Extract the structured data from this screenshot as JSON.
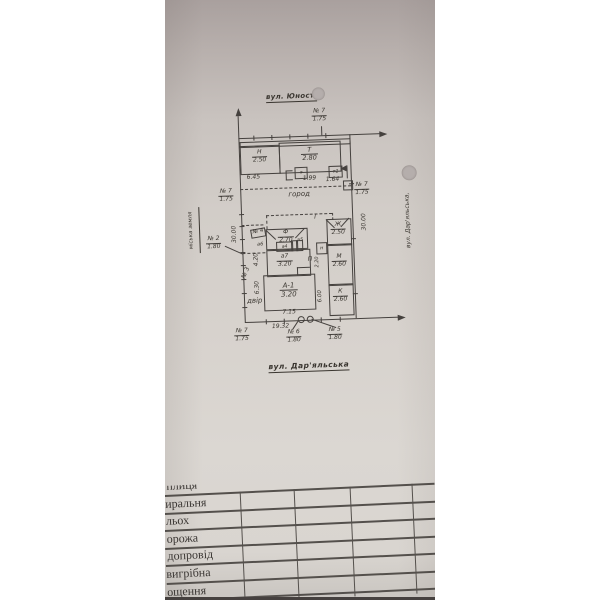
{
  "photo": {
    "streets": {
      "top": "вул. Юності",
      "right_vertical": "вул. Дар'яльська,",
      "bottom": "вул. Дар'яльська"
    },
    "land_label": "міська земля",
    "areas": {
      "garden": "город",
      "yard": "двір"
    },
    "buildings": {
      "n": {
        "letter": "Н",
        "height": "2.50"
      },
      "t": {
        "letter": "Т",
        "height": "2.80"
      },
      "f": {
        "letter": "Ф",
        "height": "2.70"
      },
      "a7": {
        "letter": "а7",
        "height": "3.20"
      },
      "a1": {
        "letter": "А-1",
        "height": "3.20"
      },
      "zh": {
        "letter": "Ж",
        "height": "2.50"
      },
      "m": {
        "letter": "М",
        "height": "2.60"
      },
      "k": {
        "letter": "К",
        "height": "2.60"
      }
    },
    "small_labels": {
      "a4": "а4",
      "a5": "а5",
      "a6": "а6",
      "t": "т",
      "t1": "т1",
      "n": "н",
      "p": "П",
      "i": "І"
    },
    "dimensions": {
      "d645": "6.45",
      "d199": "1.99",
      "d164": "1.64",
      "d3000l": "30.00",
      "d3000r": "30.00",
      "d420": "4.20",
      "d630": "6.30",
      "d600": "6.00",
      "d220": "2.20",
      "d715": "7.15",
      "d1932": "19.32"
    },
    "markers": {
      "m7top": {
        "no": "№ 7",
        "val": "1.75"
      },
      "m7left": {
        "no": "№ 7",
        "val": "1.75"
      },
      "m7right": {
        "no": "№ 7",
        "val": "1.75"
      },
      "m7bottom": {
        "no": "№ 7",
        "val": "1.75"
      },
      "m2": {
        "no": "№ 2",
        "val": "1.80"
      },
      "m3": {
        "no": "№ 3"
      },
      "m4": {
        "no": "№ 4"
      },
      "m5": {
        "no": "№ 5",
        "val": "1.80"
      },
      "m6": {
        "no": "№ 6",
        "val": "1.80"
      }
    },
    "table": {
      "clipped_top": "плиця",
      "rows": [
        "иральня",
        "льох",
        "орожа",
        "допровід",
        "вигрібна",
        "ощення"
      ]
    }
  }
}
